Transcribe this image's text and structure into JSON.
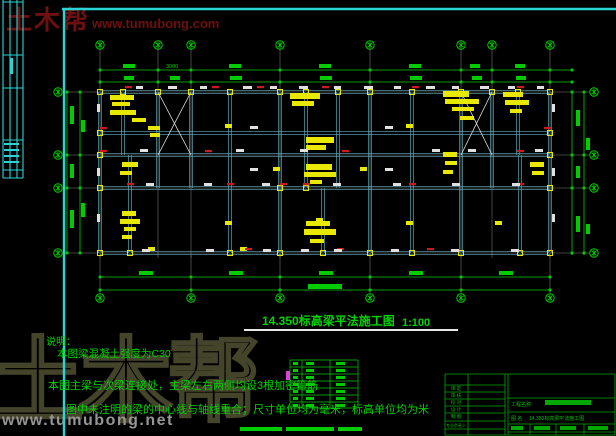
{
  "watermark_top": {
    "brand": "土木帮",
    "url": "www.tumubong.com"
  },
  "watermark_bottom": {
    "brand": "土木帮",
    "url": "www.tumubong.net"
  },
  "title": {
    "text": "14.350标高梁平法施工图",
    "scale": "1:100"
  },
  "notes": {
    "heading": "说明：",
    "line1": "本图梁混凝土强度为C30",
    "line2": "本图主梁与次梁连接处，主梁左右两侧均设3根加密箍筋",
    "line3": "图中未注明的梁的中心线与轴线重合；尺寸单位均为毫米，标高单位均为米"
  },
  "dims": {
    "top_label": "3000"
  },
  "title_block": {
    "rows": [
      "审 定",
      "审 核",
      "校 对",
      "设 计",
      "制 图",
      "专业负责人"
    ],
    "project_label": "工程名称",
    "drawing_label": "图 名",
    "drawing_name": "14.350标高梁平法施工图"
  },
  "colors": {
    "green": "#00cc00",
    "teal": "#5fb0c0",
    "white": "#e0e0e0",
    "grid": "#9a9a9a",
    "yellow": "#e8e800",
    "red": "#cc1a1a",
    "cyan": "#2ad4d4",
    "magenta": "#e040e0",
    "tblock_green": "#00a800"
  },
  "geom": {
    "frame": {
      "top_y": 9,
      "left_x": 64,
      "strip_x": [
        3,
        10,
        17,
        23
      ],
      "strip_y2": 178,
      "strip_h": [
        2,
        55,
        88,
        140,
        170,
        178
      ],
      "strip_marks": [
        [
          10,
          58,
          3,
          16
        ],
        [
          4,
          143,
          15,
          2
        ],
        [
          4,
          149,
          15,
          2
        ],
        [
          4,
          155,
          15,
          2
        ],
        [
          4,
          161,
          15,
          2
        ]
      ]
    },
    "axes_top_x": [
      100,
      158,
      191,
      280,
      370,
      461,
      492,
      550
    ],
    "axes_bottom_x": [
      100,
      191,
      280,
      370,
      461,
      550
    ],
    "rows_axis_y": [
      92,
      155,
      188,
      253
    ],
    "rows_beam_y": [
      92,
      133,
      155,
      188,
      253
    ],
    "beam_x_range": [
      100,
      550
    ],
    "verts": [
      [
        100,
        92,
        253
      ],
      [
        230,
        92,
        253
      ],
      [
        280,
        92,
        253
      ],
      [
        370,
        92,
        253
      ],
      [
        412,
        92,
        253
      ],
      [
        461,
        92,
        253
      ],
      [
        550,
        92,
        253
      ],
      [
        158,
        92,
        188
      ],
      [
        191,
        92,
        188
      ],
      [
        306,
        92,
        188
      ],
      [
        338,
        92,
        188
      ],
      [
        492,
        92,
        188
      ],
      [
        123,
        92,
        155
      ],
      [
        518,
        92,
        155
      ],
      [
        130,
        155,
        253
      ],
      [
        520,
        155,
        253
      ],
      [
        323,
        188,
        253
      ]
    ],
    "braces": [
      [
        158,
        92,
        191,
        155
      ],
      [
        191,
        92,
        158,
        155
      ],
      [
        461,
        92,
        492,
        155
      ],
      [
        492,
        92,
        461,
        155
      ]
    ],
    "top_dim_y": [
      70,
      82
    ],
    "bottom_dim_y": [
      277,
      290
    ],
    "left_dim_x": [
      67,
      80
    ],
    "right_dim_x": [
      572,
      584
    ],
    "left_bubble_x": 58,
    "right_bubble_x": 594,
    "top_bubble_y": 45,
    "bottom_bubble_y": 298,
    "green_blobs": [
      [
        123,
        64,
        12,
        4
      ],
      [
        229,
        64,
        12,
        4
      ],
      [
        319,
        64,
        12,
        4
      ],
      [
        409,
        64,
        12,
        4
      ],
      [
        470,
        64,
        10,
        4
      ],
      [
        515,
        64,
        10,
        4
      ],
      [
        124,
        76,
        10,
        4
      ],
      [
        170,
        76,
        10,
        4
      ],
      [
        230,
        76,
        12,
        4
      ],
      [
        320,
        76,
        12,
        4
      ],
      [
        410,
        76,
        12,
        4
      ],
      [
        472,
        76,
        10,
        4
      ],
      [
        516,
        76,
        10,
        4
      ],
      [
        139,
        271,
        14,
        4
      ],
      [
        229,
        271,
        14,
        4
      ],
      [
        319,
        271,
        14,
        4
      ],
      [
        409,
        271,
        14,
        4
      ],
      [
        499,
        271,
        14,
        4
      ],
      [
        308,
        284,
        34,
        5
      ],
      [
        70,
        106,
        4,
        18
      ],
      [
        70,
        164,
        4,
        14
      ],
      [
        70,
        210,
        4,
        18
      ],
      [
        81,
        120,
        4,
        12
      ],
      [
        81,
        203,
        4,
        14
      ],
      [
        576,
        110,
        4,
        16
      ],
      [
        576,
        166,
        4,
        12
      ],
      [
        576,
        216,
        4,
        16
      ],
      [
        586,
        138,
        4,
        12
      ],
      [
        586,
        224,
        4,
        10
      ],
      [
        240,
        427,
        42,
        4
      ],
      [
        286,
        427,
        48,
        4
      ],
      [
        338,
        427,
        24,
        4
      ]
    ],
    "yellow_blocks": [
      [
        110,
        95,
        24,
        5
      ],
      [
        112,
        102,
        18,
        4
      ],
      [
        110,
        110,
        26,
        5
      ],
      [
        132,
        118,
        14,
        4
      ],
      [
        148,
        126,
        12,
        4
      ],
      [
        150,
        133,
        10,
        4
      ],
      [
        290,
        93,
        30,
        6
      ],
      [
        292,
        101,
        22,
        5
      ],
      [
        443,
        91,
        26,
        6
      ],
      [
        445,
        99,
        34,
        5
      ],
      [
        452,
        107,
        22,
        4
      ],
      [
        460,
        116,
        14,
        4
      ],
      [
        503,
        92,
        20,
        5
      ],
      [
        505,
        100,
        24,
        5
      ],
      [
        510,
        109,
        12,
        4
      ],
      [
        122,
        162,
        16,
        5
      ],
      [
        120,
        171,
        12,
        4
      ],
      [
        306,
        137,
        28,
        6
      ],
      [
        306,
        145,
        20,
        5
      ],
      [
        306,
        164,
        26,
        6
      ],
      [
        304,
        172,
        32,
        5
      ],
      [
        310,
        180,
        12,
        4
      ],
      [
        443,
        152,
        14,
        5
      ],
      [
        445,
        161,
        12,
        4
      ],
      [
        443,
        170,
        10,
        4
      ],
      [
        530,
        162,
        14,
        5
      ],
      [
        532,
        171,
        12,
        4
      ],
      [
        122,
        211,
        14,
        5
      ],
      [
        120,
        219,
        20,
        5
      ],
      [
        124,
        227,
        12,
        4
      ],
      [
        122,
        235,
        10,
        4
      ],
      [
        306,
        221,
        24,
        5
      ],
      [
        304,
        229,
        32,
        6
      ],
      [
        310,
        239,
        14,
        4
      ],
      [
        225,
        124,
        7,
        4
      ],
      [
        273,
        167,
        7,
        4
      ],
      [
        360,
        167,
        7,
        4
      ],
      [
        406,
        124,
        7,
        4
      ],
      [
        225,
        221,
        7,
        4
      ],
      [
        316,
        218,
        7,
        4
      ],
      [
        406,
        221,
        7,
        4
      ],
      [
        495,
        221,
        7,
        4
      ],
      [
        148,
        247,
        7,
        4
      ],
      [
        240,
        247,
        7,
        4
      ]
    ],
    "yellow_squares": {
      "y92": [
        100,
        123,
        158,
        191,
        230,
        280,
        306,
        338,
        370,
        412,
        461,
        492,
        518,
        550
      ],
      "y253": [
        100,
        130,
        230,
        280,
        323,
        370,
        412,
        461,
        520,
        550
      ],
      "side": [
        [
          100,
          133
        ],
        [
          550,
          133
        ],
        [
          100,
          155
        ],
        [
          550,
          155
        ],
        [
          100,
          188
        ],
        [
          550,
          188
        ],
        [
          280,
          188
        ],
        [
          306,
          188
        ]
      ]
    },
    "red_marks": [
      [
        128,
        87
      ],
      [
        215,
        87
      ],
      [
        260,
        87
      ],
      [
        325,
        87
      ],
      [
        415,
        87
      ],
      [
        520,
        87
      ],
      [
        103,
        151
      ],
      [
        208,
        151
      ],
      [
        345,
        151
      ],
      [
        520,
        151
      ],
      [
        130,
        184
      ],
      [
        230,
        184
      ],
      [
        283,
        184
      ],
      [
        306,
        184
      ],
      [
        412,
        184
      ],
      [
        520,
        184
      ],
      [
        248,
        249
      ],
      [
        340,
        249
      ],
      [
        430,
        249
      ],
      [
        103,
        128
      ],
      [
        547,
        128
      ]
    ],
    "white_marks": [
      [
        136,
        86,
        7,
        3
      ],
      [
        168,
        86,
        9,
        3
      ],
      [
        200,
        86,
        7,
        3
      ],
      [
        243,
        86,
        9,
        3
      ],
      [
        270,
        86,
        7,
        3
      ],
      [
        299,
        86,
        9,
        3
      ],
      [
        334,
        86,
        7,
        3
      ],
      [
        364,
        86,
        9,
        3
      ],
      [
        394,
        86,
        7,
        3
      ],
      [
        426,
        86,
        9,
        3
      ],
      [
        452,
        86,
        7,
        3
      ],
      [
        480,
        86,
        9,
        3
      ],
      [
        508,
        86,
        7,
        3
      ],
      [
        537,
        86,
        7,
        3
      ],
      [
        140,
        149,
        8,
        3
      ],
      [
        236,
        149,
        8,
        3
      ],
      [
        300,
        149,
        8,
        3
      ],
      [
        432,
        149,
        8,
        3
      ],
      [
        468,
        149,
        8,
        3
      ],
      [
        535,
        149,
        8,
        3
      ],
      [
        146,
        183,
        8,
        3
      ],
      [
        204,
        183,
        8,
        3
      ],
      [
        262,
        183,
        8,
        3
      ],
      [
        333,
        183,
        8,
        3
      ],
      [
        393,
        183,
        8,
        3
      ],
      [
        452,
        183,
        8,
        3
      ],
      [
        512,
        183,
        8,
        3
      ],
      [
        142,
        249,
        8,
        3
      ],
      [
        206,
        249,
        8,
        3
      ],
      [
        263,
        249,
        8,
        3
      ],
      [
        301,
        249,
        8,
        3
      ],
      [
        334,
        249,
        8,
        3
      ],
      [
        391,
        249,
        8,
        3
      ],
      [
        451,
        249,
        8,
        3
      ],
      [
        511,
        249,
        8,
        3
      ],
      [
        250,
        126,
        8,
        3
      ],
      [
        385,
        126,
        8,
        3
      ],
      [
        250,
        168,
        8,
        3
      ],
      [
        385,
        168,
        8,
        3
      ],
      [
        97,
        104,
        3,
        8
      ],
      [
        97,
        168,
        3,
        8
      ],
      [
        97,
        214,
        3,
        8
      ],
      [
        552,
        104,
        3,
        8
      ],
      [
        552,
        168,
        3,
        8
      ],
      [
        552,
        214,
        3,
        8
      ]
    ],
    "table": {
      "x": [
        290,
        302,
        330,
        358
      ],
      "y": [
        360,
        367,
        374,
        381,
        388,
        395,
        402,
        408
      ],
      "magenta": [
        286,
        371,
        4,
        9
      ]
    },
    "tblock": {
      "x0": 445,
      "x1": 468,
      "x2": 505,
      "x3": 508,
      "x4": 615,
      "left_rows_y": [
        374,
        385,
        392,
        399,
        406,
        413,
        421,
        429,
        435
      ],
      "right_rows_y": [
        374,
        398,
        412,
        424,
        432
      ],
      "bot_cols_x": [
        530,
        556,
        584
      ],
      "blobs": [
        [
          545,
          400,
          46,
          5
        ],
        [
          511,
          426,
          12,
          4
        ],
        [
          534,
          426,
          16,
          4
        ],
        [
          560,
          426,
          16,
          4
        ],
        [
          588,
          426,
          20,
          4
        ]
      ]
    }
  }
}
